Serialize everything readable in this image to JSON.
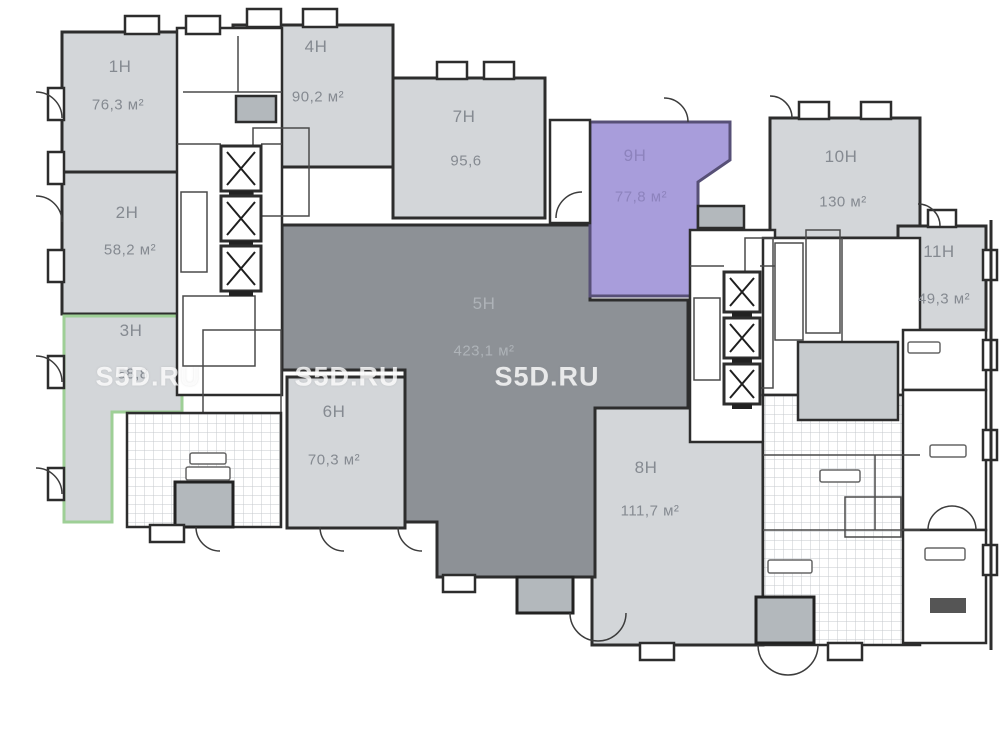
{
  "plan_title": "Commercial units floor plan",
  "colors": {
    "room_light": "#d3d6d9",
    "room_dark": "#8d9196",
    "unit_highlight_fill": "#a89ddb",
    "unit_highlight_stroke": "#575077",
    "selected_outline_green": "#9ecf96",
    "wall": "#2d2d2d",
    "gray_block": "#b3b8bc",
    "gray_block_light": "#c7cbce"
  },
  "watermark": {
    "text": "S5D.RU",
    "positions": [
      [
        148,
        377
      ],
      [
        347,
        377
      ],
      [
        547,
        377
      ]
    ]
  },
  "units": [
    {
      "id": "1h",
      "label": "1Н",
      "area": "76,3 м²",
      "theme": "light",
      "label_pos": [
        120,
        67
      ],
      "area_pos": [
        118,
        105
      ]
    },
    {
      "id": "2h",
      "label": "2Н",
      "area": "58,2 м²",
      "theme": "light",
      "label_pos": [
        127,
        213
      ],
      "area_pos": [
        130,
        250
      ]
    },
    {
      "id": "3h",
      "label": "3Н",
      "area": "58,8",
      "theme": "light",
      "label_pos": [
        131,
        331
      ],
      "area_pos": [
        133,
        374
      ]
    },
    {
      "id": "4h",
      "label": "4Н",
      "area": "90,2 м²",
      "theme": "light",
      "label_pos": [
        316,
        47
      ],
      "area_pos": [
        318,
        97
      ]
    },
    {
      "id": "5h",
      "label": "5Н",
      "area": "423,1 м²",
      "theme": "dark",
      "label_pos": [
        484,
        304
      ],
      "area_pos": [
        484,
        351
      ]
    },
    {
      "id": "6h",
      "label": "6Н",
      "area": "70,3 м²",
      "theme": "light",
      "label_pos": [
        334,
        412
      ],
      "area_pos": [
        334,
        460
      ]
    },
    {
      "id": "7h",
      "label": "7Н",
      "area": "95,6",
      "theme": "light",
      "label_pos": [
        464,
        117
      ],
      "area_pos": [
        466,
        161
      ]
    },
    {
      "id": "8h",
      "label": "8Н",
      "area": "111,7 м²",
      "theme": "light",
      "label_pos": [
        646,
        468
      ],
      "area_pos": [
        650,
        511
      ]
    },
    {
      "id": "9h",
      "label": "9Н",
      "area": "77,8 м²",
      "theme": "purple",
      "label_pos": [
        635,
        156
      ],
      "area_pos": [
        641,
        197
      ]
    },
    {
      "id": "10h",
      "label": "10Н",
      "area": "130 м²",
      "theme": "light",
      "label_pos": [
        841,
        157
      ],
      "area_pos": [
        843,
        202
      ]
    },
    {
      "id": "11h",
      "label": "11Н",
      "area": "49,3 м²",
      "theme": "light",
      "label_pos": [
        939,
        252
      ],
      "area_pos": [
        944,
        299
      ]
    }
  ]
}
